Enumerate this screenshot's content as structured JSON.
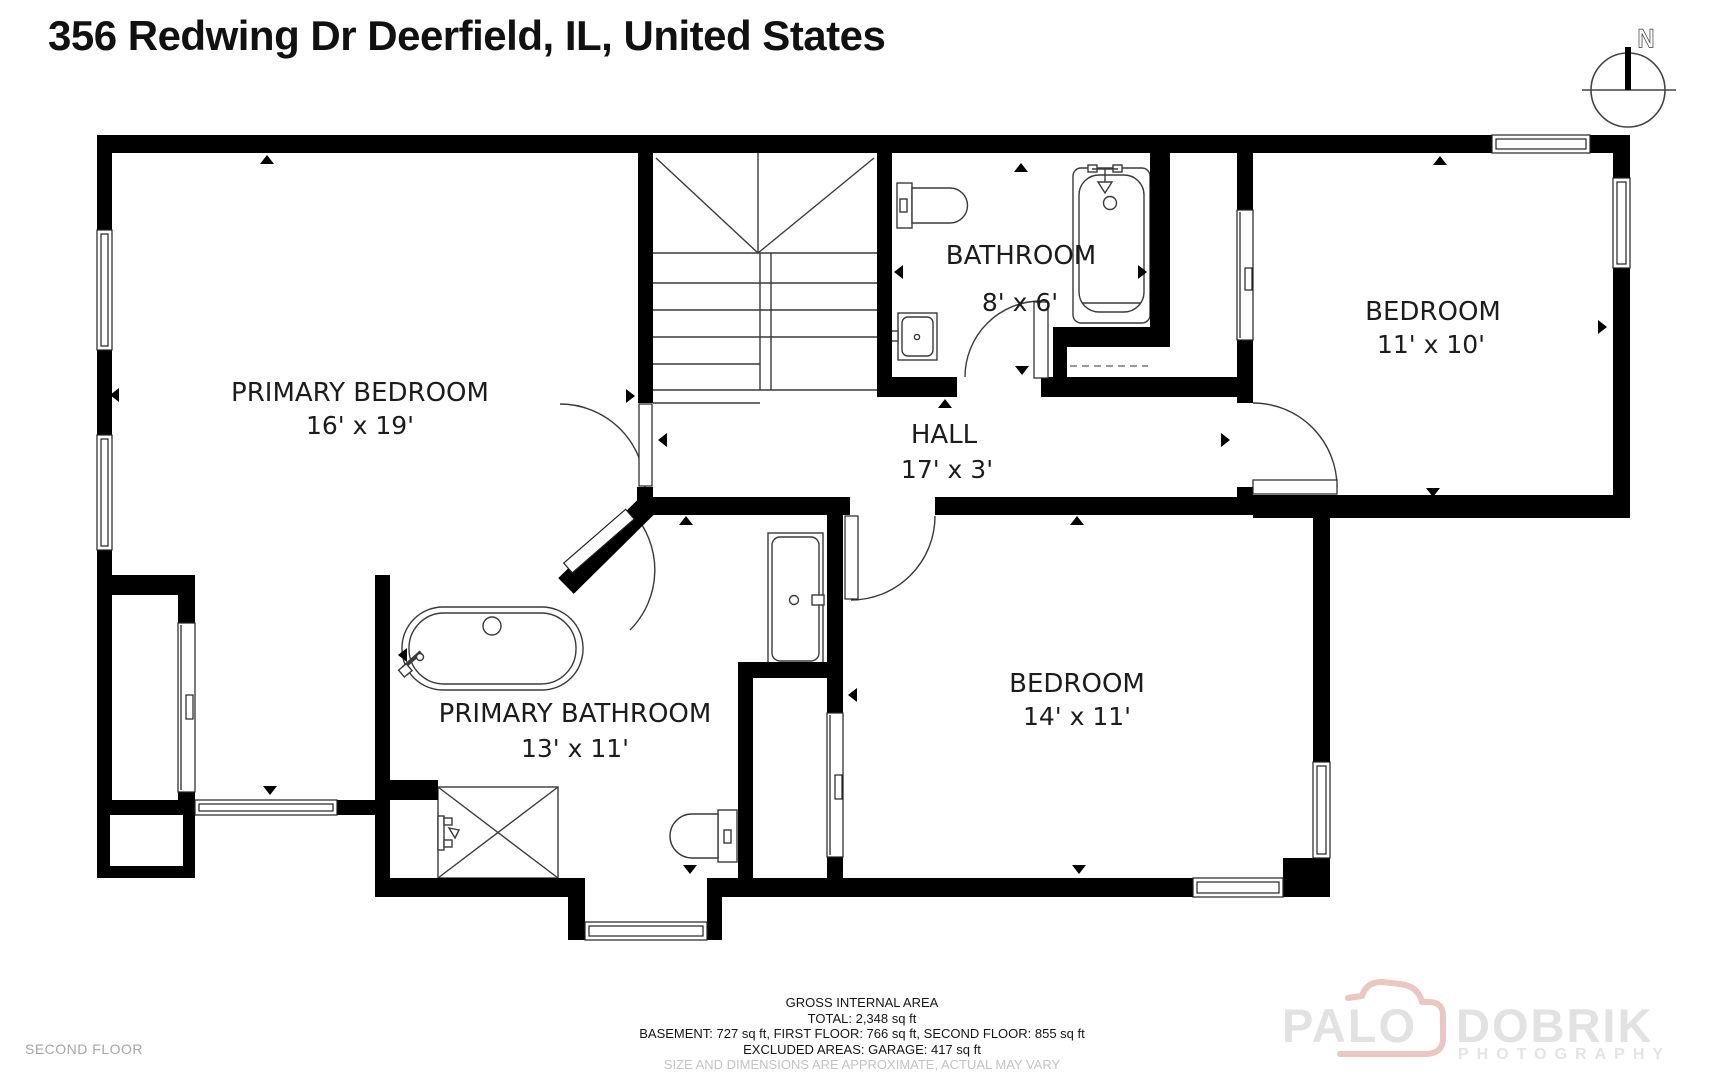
{
  "title": "356 Redwing Dr Deerfield, IL, United States",
  "floor_label": "SECOND FLOOR",
  "compass": {
    "north_label": "N"
  },
  "rooms": [
    {
      "name": "PRIMARY BEDROOM",
      "dims": "16' x 19'"
    },
    {
      "name": "BATHROOM",
      "dims": "8' x 6'"
    },
    {
      "name": "BEDROOM",
      "dims": "11' x 10'"
    },
    {
      "name": "HALL",
      "dims": "17' x 3'"
    },
    {
      "name": "PRIMARY BATHROOM",
      "dims": "13' x 11'"
    },
    {
      "name": "BEDROOM",
      "dims": "14' x 11'"
    }
  ],
  "footer": {
    "line1": "GROSS INTERNAL AREA",
    "line2": "TOTAL: 2,348 sq ft",
    "line3": "BASEMENT: 727 sq ft, FIRST FLOOR: 766 sq ft, SECOND FLOOR: 855 sq ft",
    "line4": "EXCLUDED AREAS: GARAGE: 417 sq ft",
    "line5": "SIZE AND DIMENSIONS ARE APPROXIMATE, ACTUAL MAY VARY"
  },
  "watermark": {
    "brand_left": "PALO",
    "brand_right": "DOBRIK",
    "subtitle": "PHOTOGRAPHY"
  },
  "colors": {
    "wall": "#000000",
    "fixture_line": "#3a3a3a",
    "muted_text": "#a6a6a6",
    "watermark_gray": "#e2e2e2",
    "watermark_pink": "#ecc6c0"
  }
}
